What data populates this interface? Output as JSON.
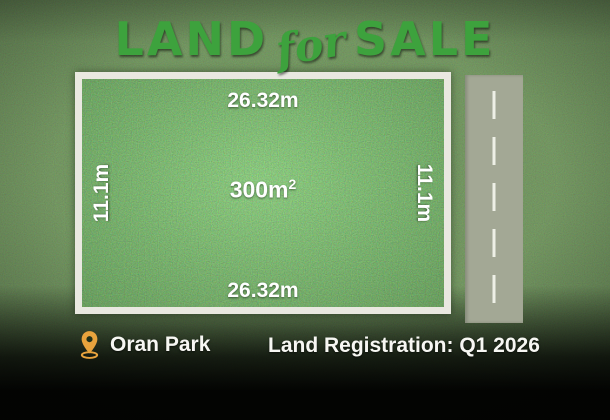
{
  "title": {
    "land": "LAND",
    "for": "for",
    "sale": "SALE"
  },
  "plot": {
    "top_dimension": "26.32m",
    "bottom_dimension": "26.32m",
    "left_dimension": "11.1m",
    "right_dimension": "11.1m",
    "area_value": "300m",
    "area_sup": "2"
  },
  "footer": {
    "location": "Oran Park",
    "registration": "Land Registration: Q1 2026"
  },
  "icons": {
    "location_pin": "map-pin-icon"
  },
  "colors": {
    "title_green": "#3da23d",
    "background_green": "#2b431f",
    "grass_green": "#3b8c2f",
    "plot_border": "#e9e8e0",
    "road_gray": "#a3a895",
    "pin_orange": "#e8a33d",
    "text_white": "#ffffff"
  }
}
